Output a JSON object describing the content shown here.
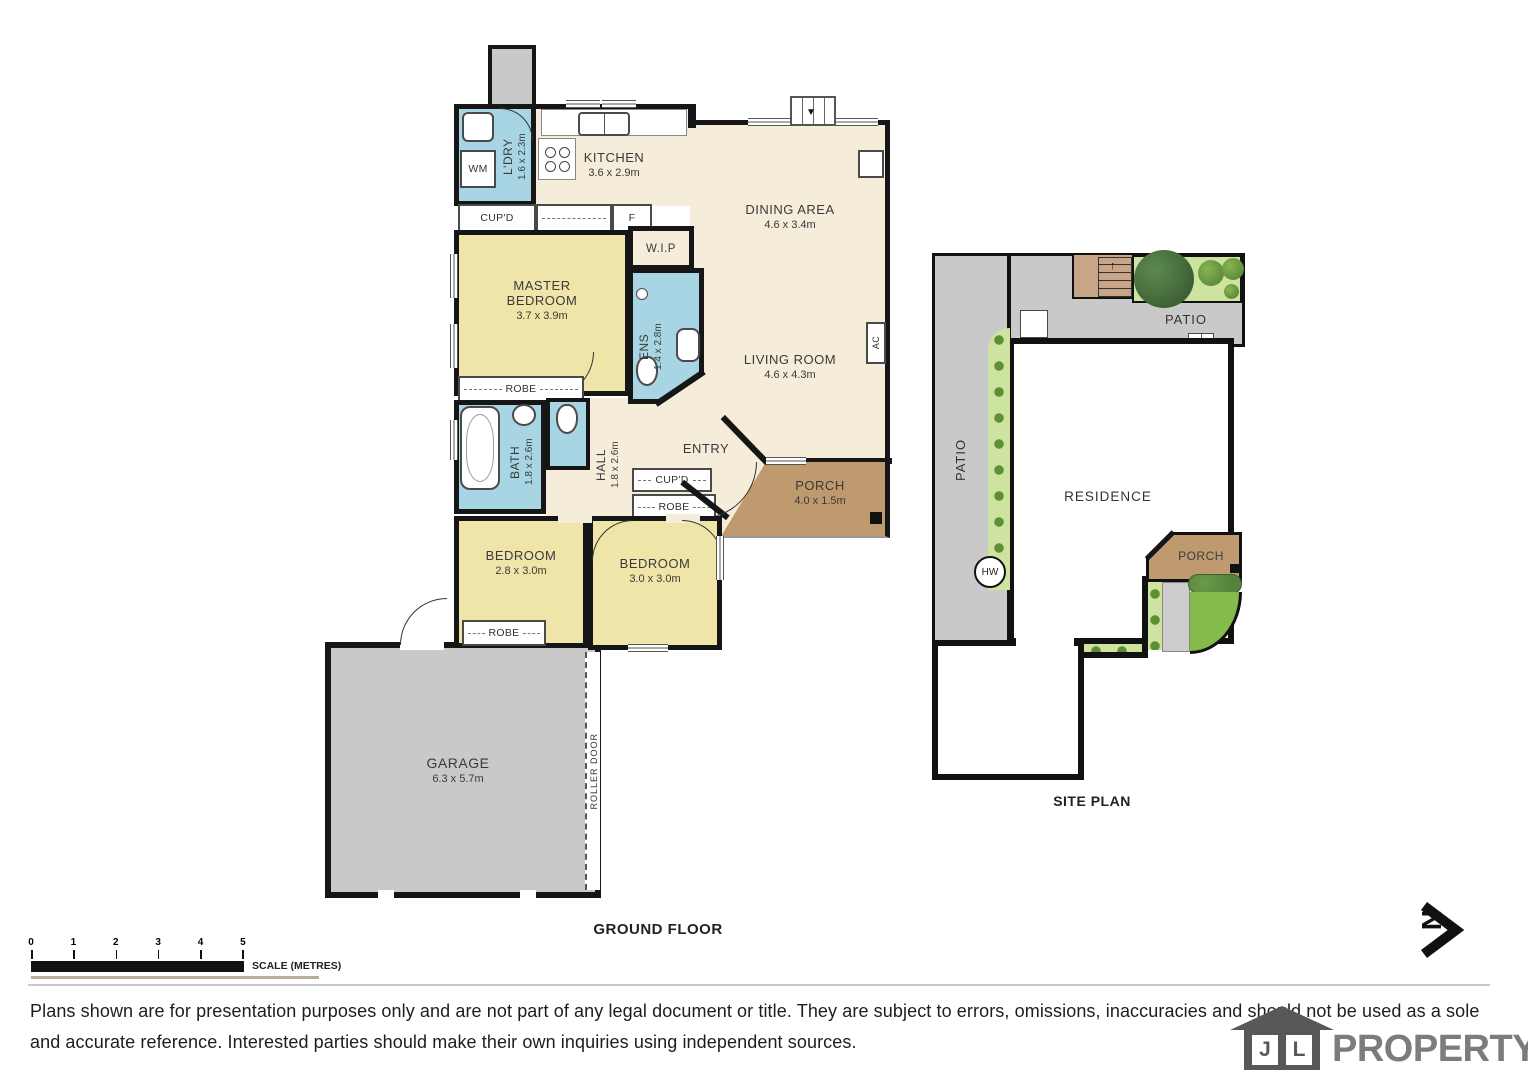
{
  "meta": {
    "ground_floor_title": "GROUND FLOOR",
    "site_plan_title": "SITE PLAN"
  },
  "rooms": {
    "laundry": {
      "name": "L'DRY",
      "dims": "1.6 x 2.3m"
    },
    "kitchen": {
      "name": "KITCHEN",
      "dims": "3.6 x 2.9m"
    },
    "dining": {
      "name": "DINING AREA",
      "dims": "4.6 x 3.4m"
    },
    "living": {
      "name": "LIVING ROOM",
      "dims": "4.6 x 4.3m"
    },
    "wip": {
      "name": "W.I.P"
    },
    "master": {
      "name": "MASTER BEDROOM",
      "dims": "3.7 x 3.9m"
    },
    "ens": {
      "name": "ENS",
      "dims": "1.4 x 2.8m"
    },
    "bath": {
      "name": "BATH",
      "dims": "1.8 x 2.6m"
    },
    "hall": {
      "name": "HALL",
      "dims": "1.8 x 2.6m"
    },
    "entry": {
      "name": "ENTRY"
    },
    "porch": {
      "name": "PORCH",
      "dims": "4.0 x 1.5m"
    },
    "bedroom1": {
      "name": "BEDROOM",
      "dims": "2.8 x 3.0m"
    },
    "bedroom2": {
      "name": "BEDROOM",
      "dims": "3.0 x 3.0m"
    },
    "garage": {
      "name": "GARAGE",
      "dims": "6.3 x 5.7m"
    }
  },
  "fixtures": {
    "wm": "WM",
    "cupd": "CUP'D",
    "fridge": "F",
    "robe": "ROBE",
    "ac": "AC",
    "roller_door": "ROLLER DOOR"
  },
  "site_plan": {
    "patio_left": "PATIO",
    "patio_top": "PATIO",
    "residence": "RESIDENCE",
    "porch": "PORCH",
    "hw": "HW"
  },
  "icons": {
    "stairs_down_arrow": "▼",
    "stairs_up_arrow": "↑"
  },
  "scale_bar": {
    "ticks": [
      "0",
      "1",
      "2",
      "3",
      "4",
      "5"
    ],
    "label": "SCALE (METRES)"
  },
  "compass": {
    "north": "N"
  },
  "footer": {
    "disclaimer": "Plans shown are for presentation purposes only and are not part of any legal document or title. They are subject to errors, omissions, inaccuracies and should not be used as a sole and accurate reference. Interested parties should make their own inquiries using independent sources.",
    "logo_j": "J",
    "logo_l": "L",
    "logo_text": "PROPERTY"
  },
  "colors": {
    "wall": "#161616",
    "floor_cream": "#f5ecda",
    "bedroom_yellow": "#efe5a9",
    "wet_area_blue": "#a8d5e3",
    "porch_brown": "#bf9a6f",
    "garage_gray": "#c9c9c9",
    "garden_green": "#cfe3a0",
    "lawn_green": "#83bc4b"
  }
}
